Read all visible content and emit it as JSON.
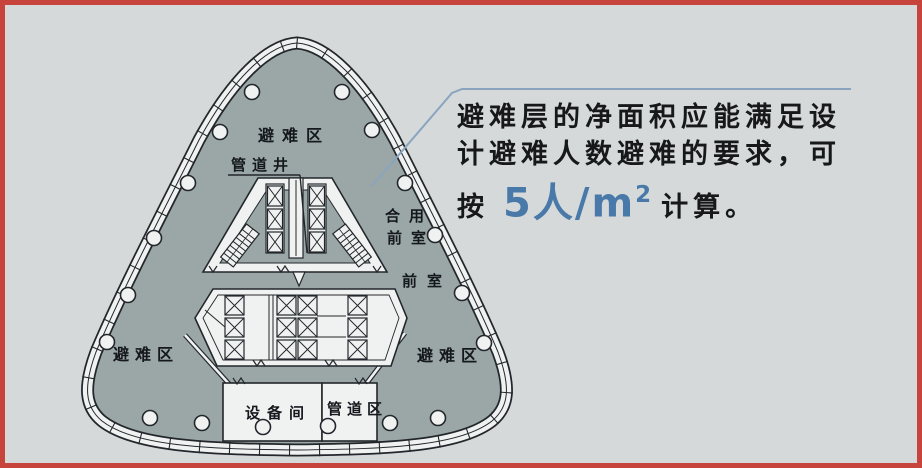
{
  "frame": {
    "border_color": "#c7443d",
    "background_color": "#d6d9da"
  },
  "annotation": {
    "line1": "避难层的净面积应能满足设",
    "line2": "计避难人数避难的要求，可",
    "line3_prefix": "按",
    "highlight_value": "5人/m",
    "highlight_sup": "2",
    "line3_suffix": "计算。",
    "highlight_color": "#4879a8",
    "leader_color": "#8aa4c0"
  },
  "plan": {
    "labels": {
      "refuge_top": "避难区",
      "refuge_left": "避难区",
      "refuge_right": "避难区",
      "pipe_shaft": "管道井",
      "shared_lobby_line1": "合用",
      "shared_lobby_line2": "前室",
      "front_room": "前室",
      "equipment_room": "设备间",
      "pipe_zone": "管道区"
    },
    "colors": {
      "floor_fill": "#9aa7a6",
      "wall_fill": "#f0f2f2",
      "line": "#23272b",
      "label": "#15181c"
    }
  }
}
